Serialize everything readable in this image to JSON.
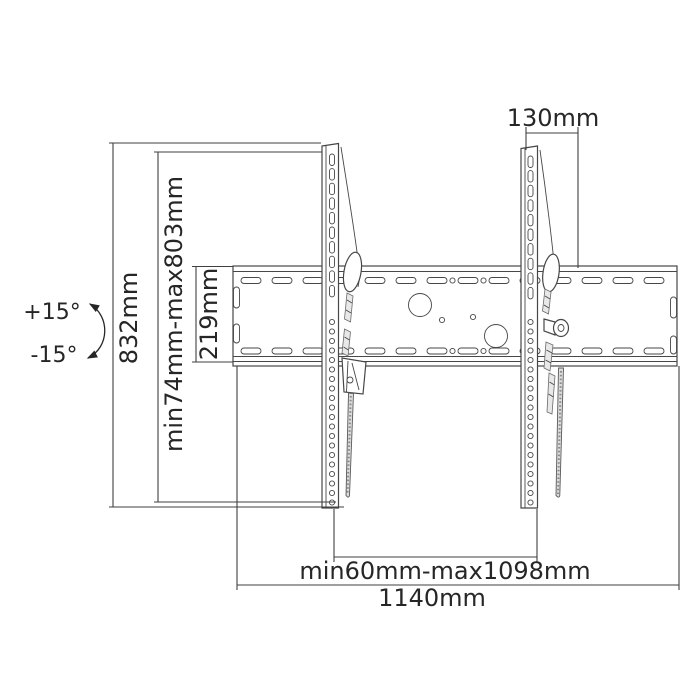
{
  "diagram": {
    "title": "tilting-tv-wall-mount-technical-drawing",
    "labels": {
      "total_height": "832mm",
      "vesa_height_range": "min74mm-max803mm",
      "wall_plate_height": "219mm",
      "bracket_top_offset": "130mm",
      "bracket_spacing_range": "min60mm-max1098mm",
      "wall_plate_width": "1140mm",
      "tilt_up": "+15°",
      "tilt_down": "-15°"
    },
    "icons": {
      "tilt_arc": "curved-double-arrow"
    },
    "colors": {
      "background": "#ffffff",
      "line": "#3f3f3f",
      "text": "#262626"
    }
  }
}
